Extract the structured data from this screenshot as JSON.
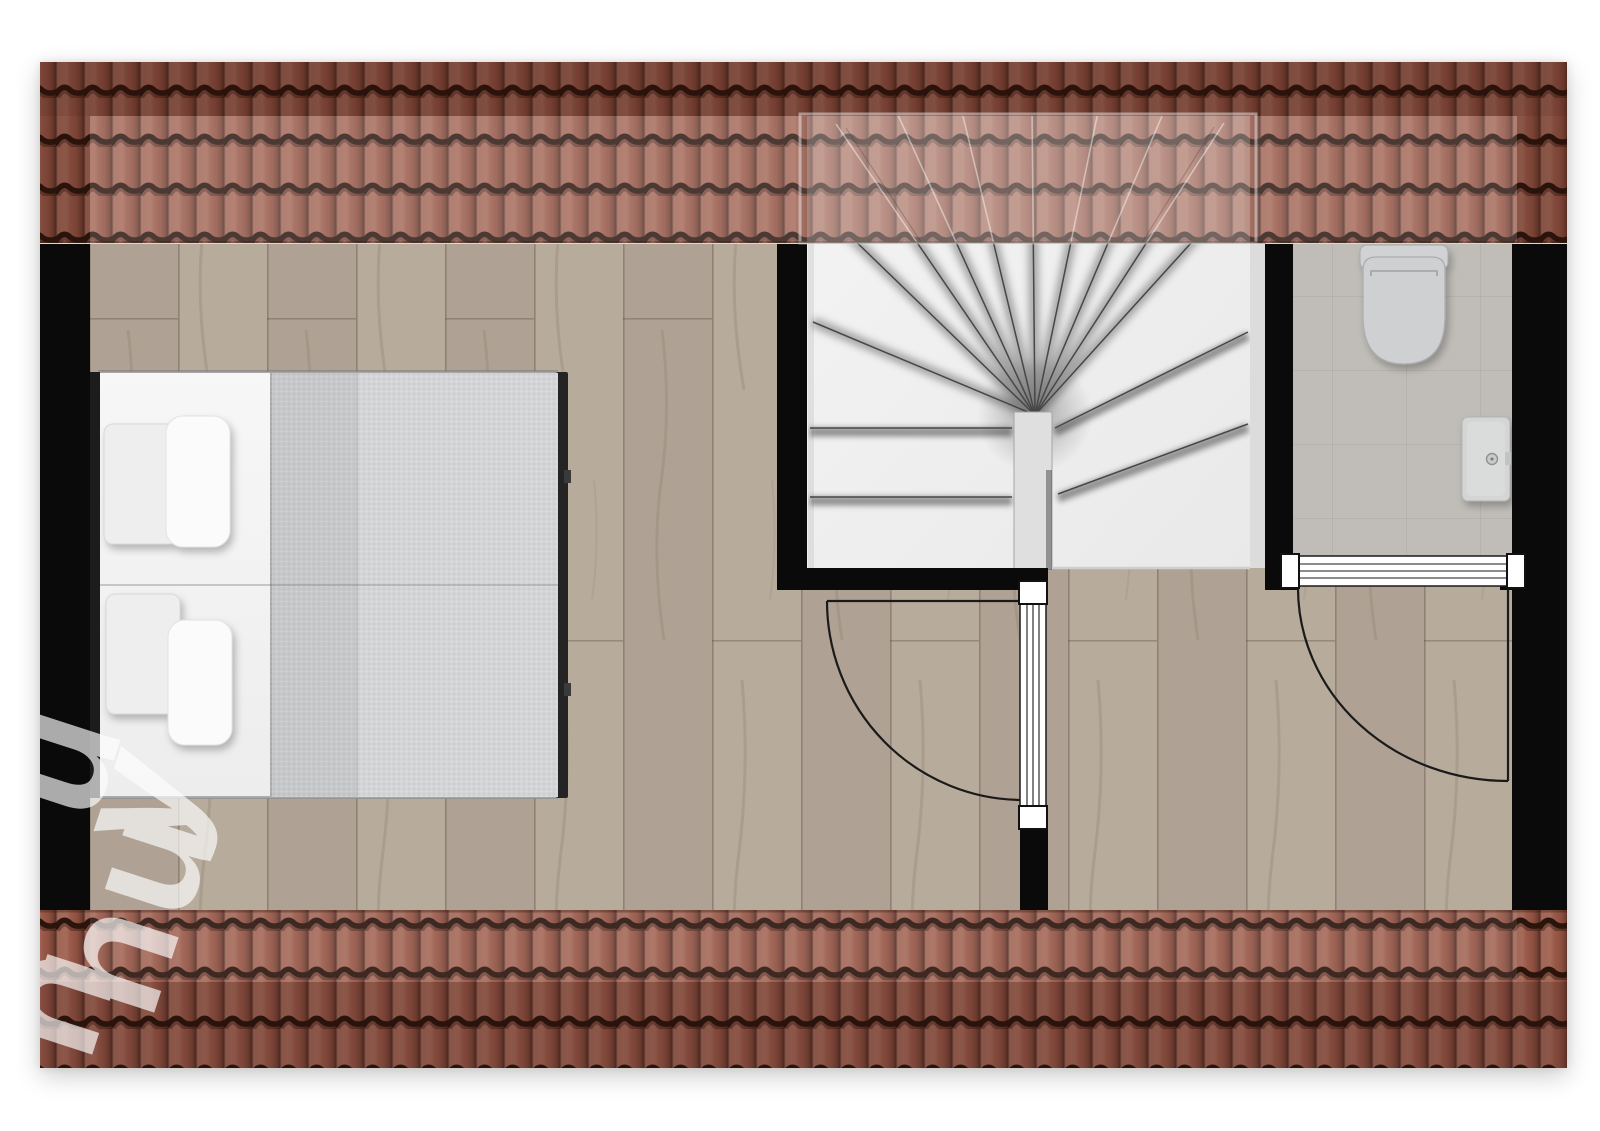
{
  "watermark": {
    "letters": [
      "u",
      "y",
      "u",
      "h",
      "n"
    ]
  },
  "palette": {
    "page_bg": "#ffffff",
    "wall": "#0a0a0a",
    "roof_base": "#975747",
    "roof_groove": "#2a140c",
    "wood": "#b7ab9c",
    "wood_alt": "#afa294",
    "bath_tile": "#c8c5c0",
    "stair_bg": "#f1f1f1",
    "stair_edge": "#474747",
    "newel": "#dfdfdf",
    "mattress": "#f4f4f4",
    "blanket": "#d4d5d7",
    "blanket_fold": "#c7c8ca",
    "pillow": "#fbfbfb",
    "fixture": "#d0d2d4",
    "fixture_outline": "#a8abad",
    "door_line": "#1a1a1a",
    "watermark_color": "#ffffff"
  },
  "plan": {
    "rooms": [
      {
        "id": "bedroom"
      },
      {
        "id": "landing"
      },
      {
        "id": "bathroom"
      },
      {
        "id": "stairwell"
      }
    ],
    "fixtures": [
      {
        "id": "double-bed"
      },
      {
        "id": "pillows"
      },
      {
        "id": "winder-staircase"
      },
      {
        "id": "toilet"
      },
      {
        "id": "washbasin"
      },
      {
        "id": "swing-door-bedroom"
      },
      {
        "id": "swing-door-bathroom"
      }
    ]
  }
}
